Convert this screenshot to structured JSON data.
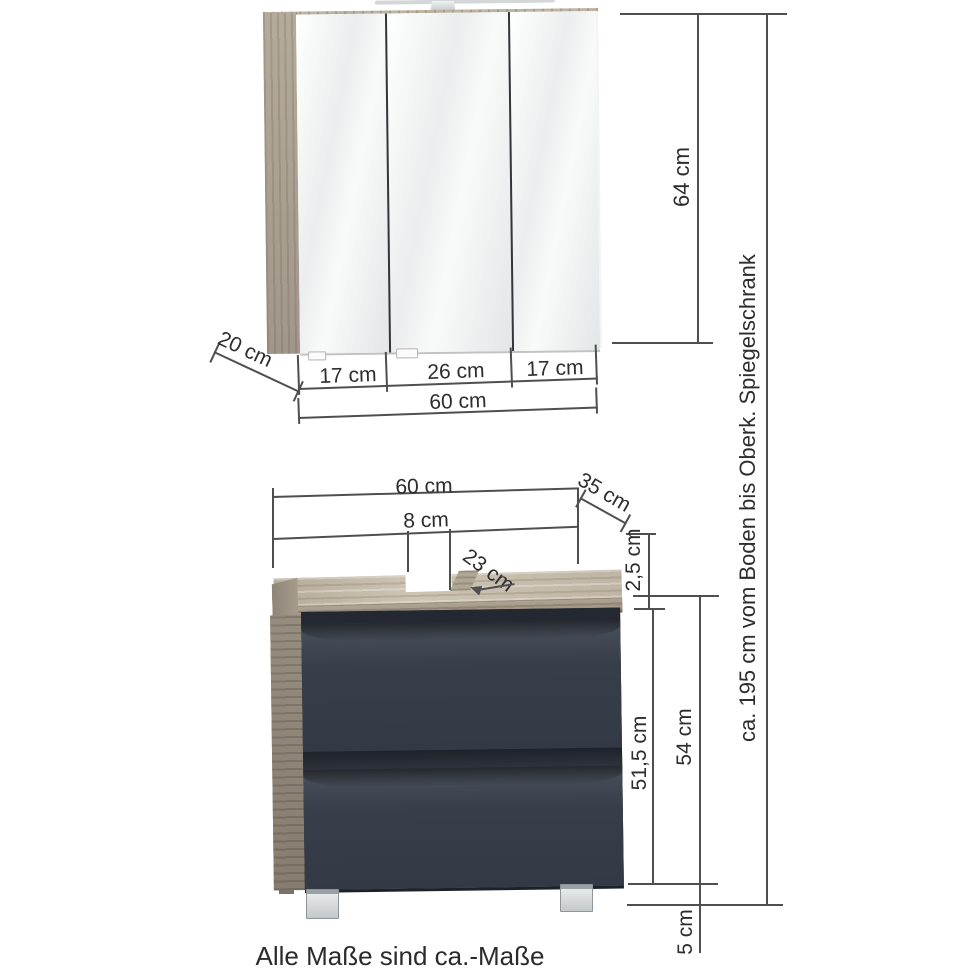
{
  "note": "Alle Maße sind ca.-Maße",
  "mirror_cabinet": {
    "height_label": "64 cm",
    "depth_label": "20 cm",
    "door_widths": [
      "17 cm",
      "26 cm",
      "17 cm"
    ],
    "width_label": "60 cm"
  },
  "vanity": {
    "width_label": "60 cm",
    "depth_label": "35 cm",
    "notch_offset_label": "8 cm",
    "notch_depth_label": "23 cm",
    "top_thickness_label": "2,5 cm",
    "front_height_label": "51,5 cm",
    "height_label": "54 cm",
    "feet_height_label": "5 cm"
  },
  "overall_height_label": "ca. 195 cm vom Boden bis Oberk. Spiegelschrank",
  "colors": {
    "dimension_line": "#4f4f4f",
    "text": "#2d2d2d",
    "wood_light": "#cdc4b4",
    "wood_medium": "#b2a796",
    "wood_dark": "#8f8577",
    "drawer_front": "#3a4049",
    "mirror": "#f2f3f3",
    "foot": "#dcdfe1"
  }
}
